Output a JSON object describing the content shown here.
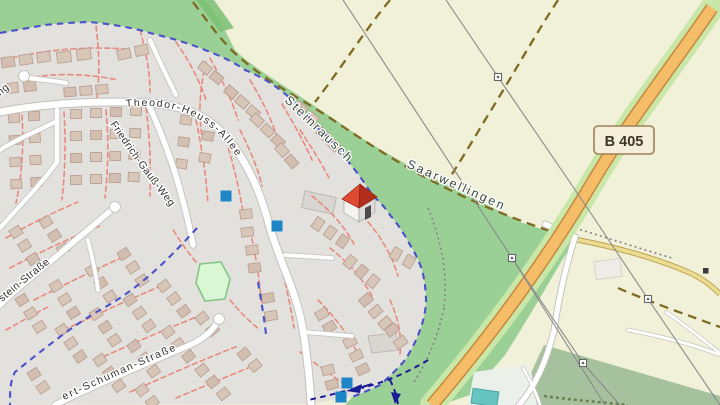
{
  "map": {
    "street_labels": {
      "theodor": "Theodor-Heuss-Allee",
      "friedrich": "Friedrich-Gauß-Weg",
      "stein": "stein-Straße",
      "schuman": "ert-Schuman-Straße",
      "ng_fragment": "ng"
    },
    "place_labels": {
      "steinrausch": "Steinrausch",
      "saarwellingen": "Saarwellingen"
    },
    "road_badge": {
      "ref": "B 405"
    },
    "icons": {
      "house_marker": "house-3d-icon",
      "route_marker": "blue-square-marker",
      "conifer": "conifer-tree-icon",
      "deciduous": "deciduous-tree-icon",
      "grave": "grave-cross-icon",
      "power_tower": "power-tower-icon",
      "oneway_arrow": "navy-arrow-icon"
    },
    "colors": {
      "residential": "#e3e1de",
      "farmland": "#f1f0d8",
      "forest": "#9ad095",
      "forest_dark": "#79c073",
      "cemetery": "#a6c19e",
      "playground": "#d9f7d4",
      "playground_border": "#86c584",
      "deck": "#ebf0ea",
      "pool": "#67c5c1",
      "pool_border": "#47a7a3",
      "building": "#d8c6b9",
      "building_stroke": "#b9a091",
      "building_big": "#d9d5d0",
      "road_white": "#ffffff",
      "road_casing": "#c7c4c0",
      "b405_fill": "#f6bd69",
      "b405_casing": "#c6873b",
      "b405_verge": "#c8e7a9",
      "yellow_fill": "#ecdc93",
      "yellow_casing": "#b59a43",
      "footpath": "#e8897c",
      "cycleway": "#4a52c9",
      "route_navy": "#1a1a96",
      "track": "#7e6b23",
      "path_dotted": "#818181",
      "hedge": "#70804f",
      "power": "#8a8a8a",
      "marker_blue": "#1e86c6",
      "roof_light": "#e04a30",
      "roof_dark": "#b12d1c",
      "label": "#333333",
      "place_label": "#3a4a40",
      "badge_bg": "#f5eedb",
      "badge_border": "#a08055",
      "badge_text": "#3f3426"
    }
  }
}
